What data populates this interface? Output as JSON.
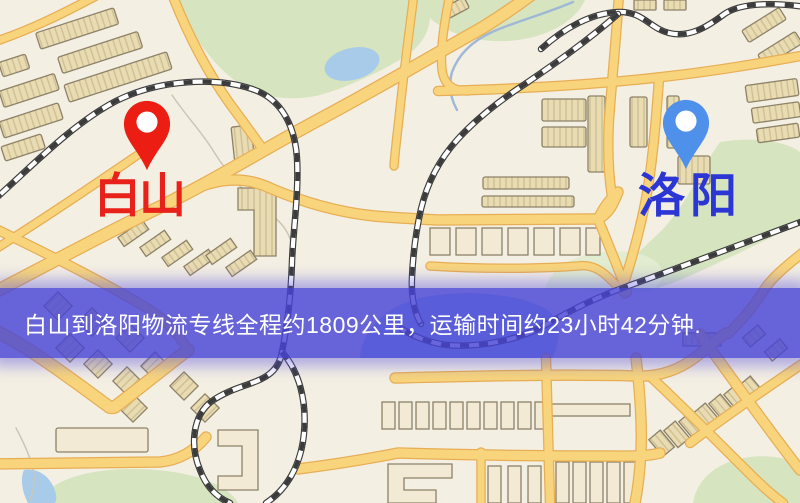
{
  "map": {
    "origin": {
      "label": "白山"
    },
    "destination": {
      "label": "洛阳"
    },
    "banner": {
      "text": "白山到洛阳物流专线全程约1809公里，运输时间约23小时42分钟."
    },
    "colors": {
      "background": "#f4efe3",
      "road": "#f8d57c",
      "road_casing": "#e7ae55",
      "building": "#e9dcb2",
      "building_outline": "#8d8268",
      "park": "#d6e5c0",
      "water": "#a7cbe9",
      "railway": "#3b3b3b",
      "origin_color": "#e8211a",
      "origin_pin": "#ec1d12",
      "destination_color": "#2b36d4",
      "destination_pin": "#4e90ea",
      "banner_bg": "rgba(72,68,214,0.82)",
      "banner_text": "#ffffff"
    }
  }
}
